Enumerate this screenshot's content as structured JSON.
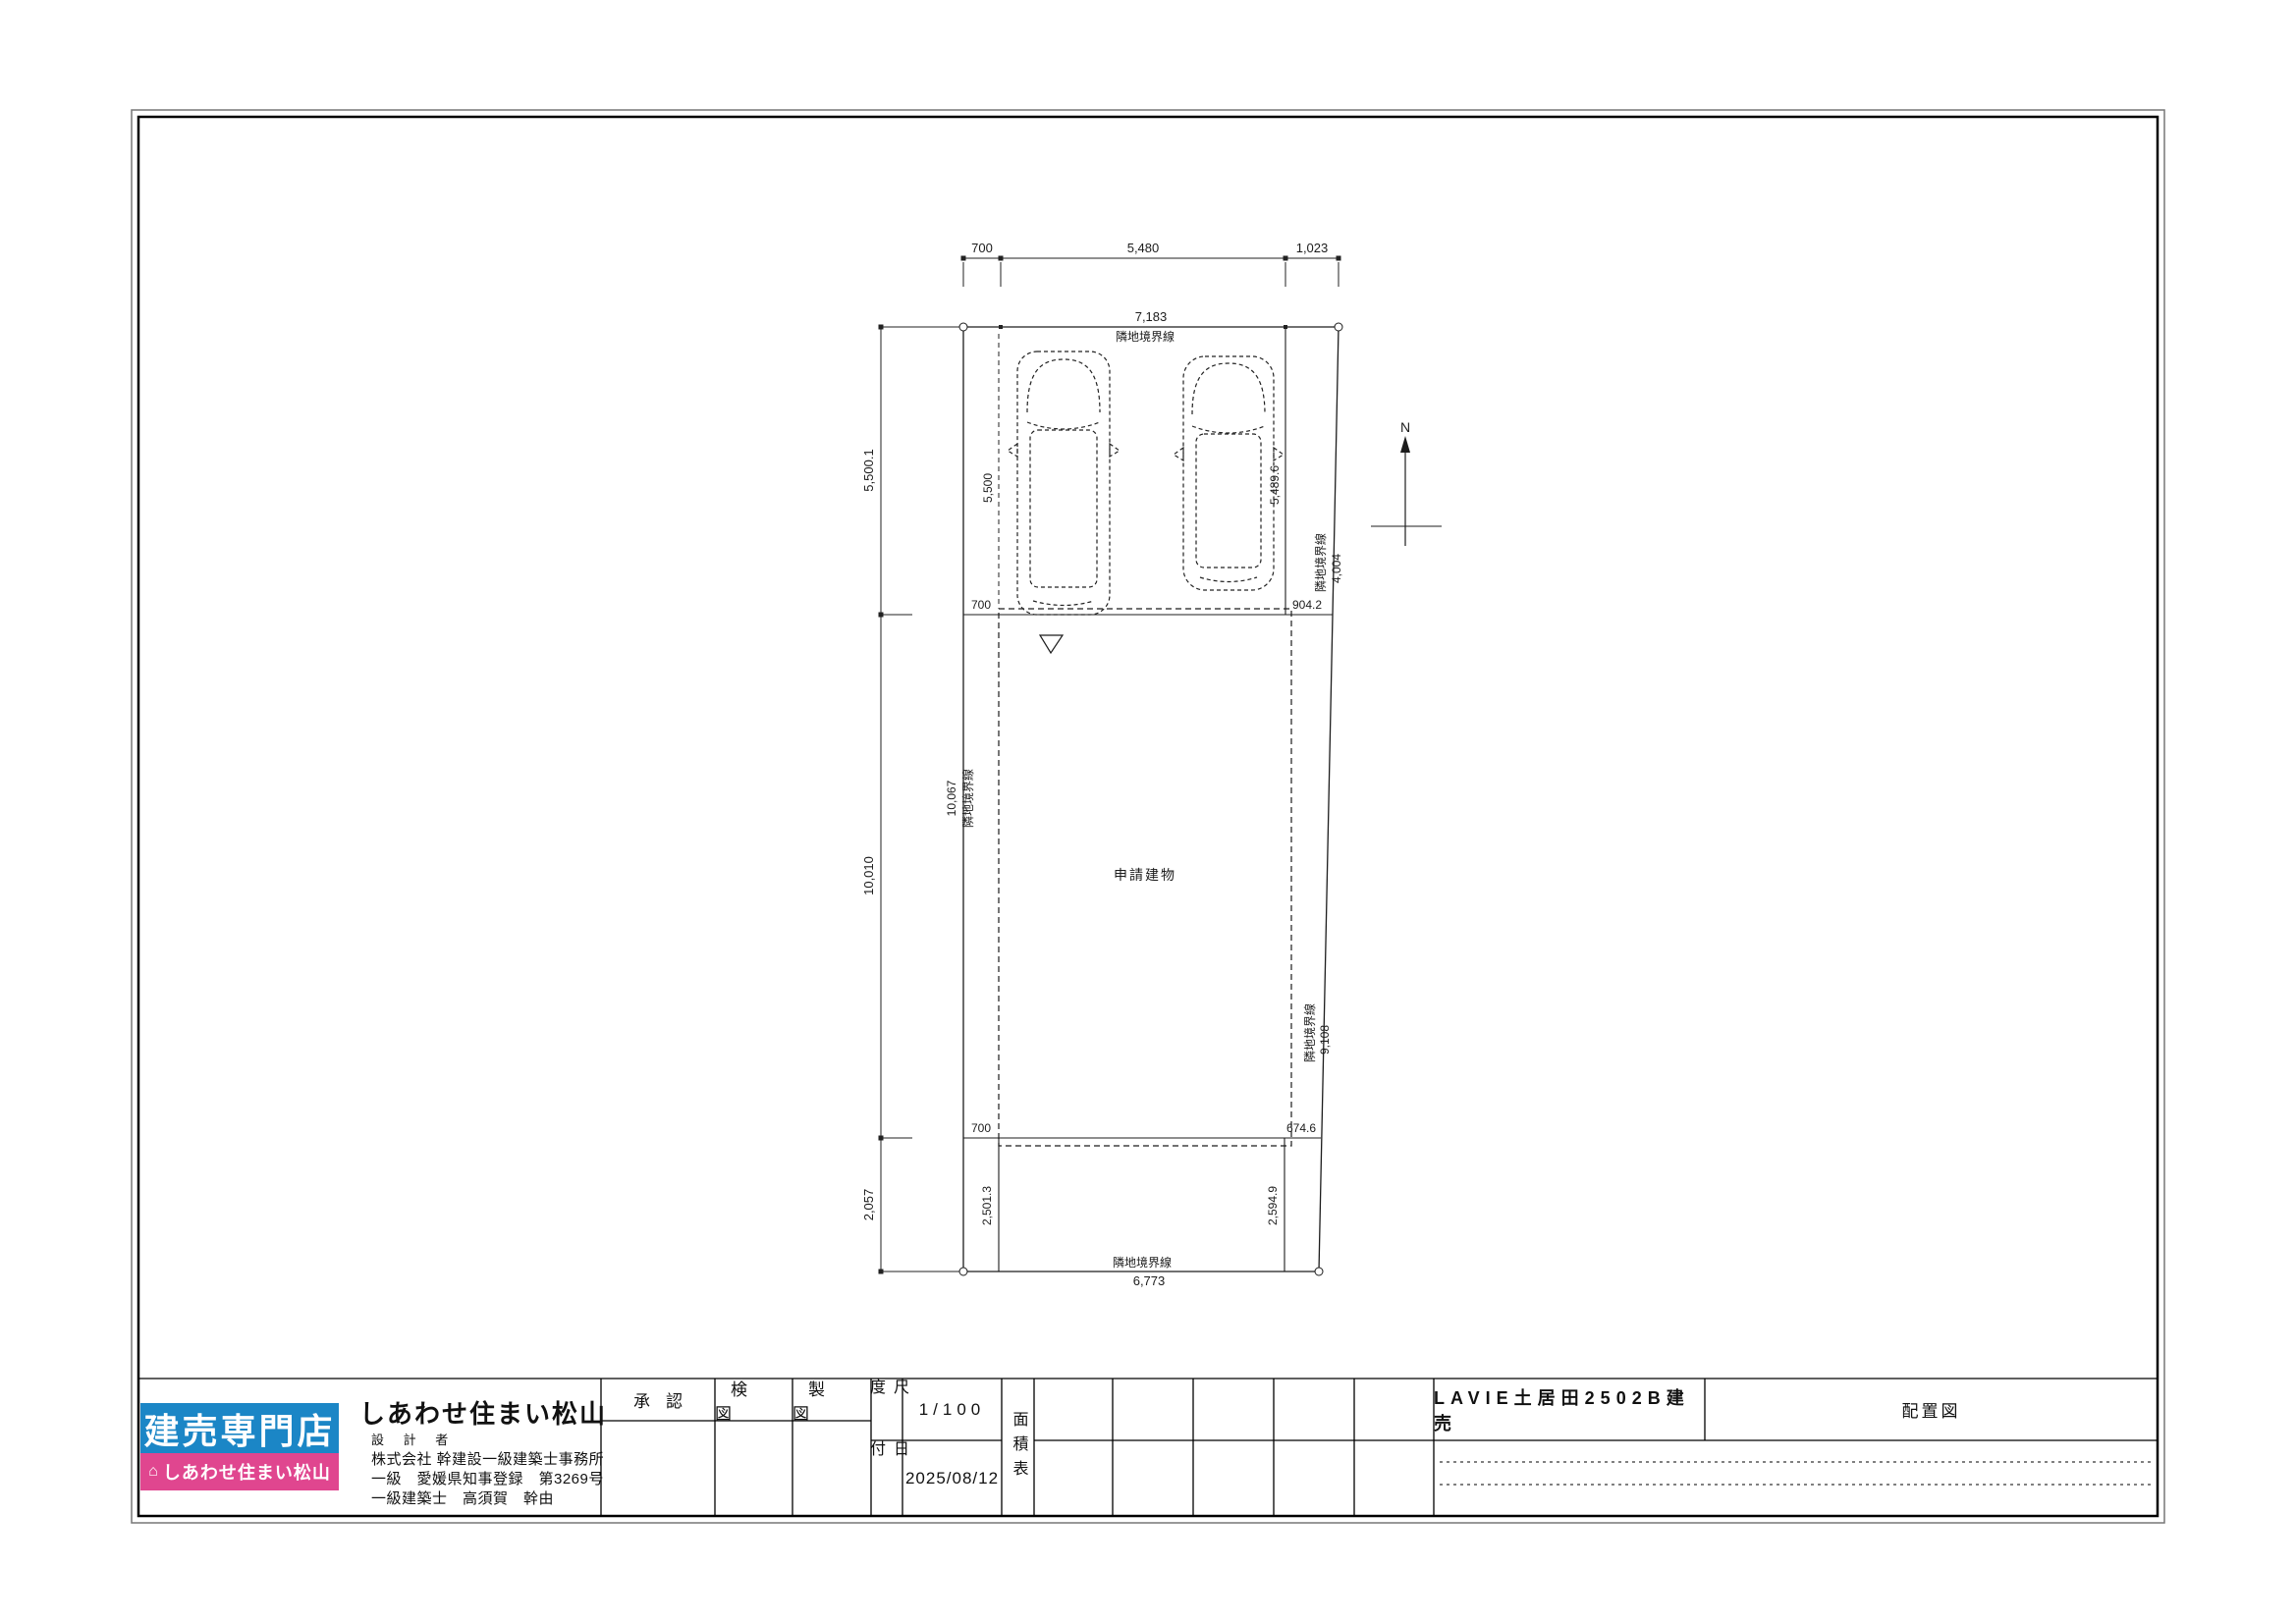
{
  "plan": {
    "north": "N",
    "building_label": "申請建物",
    "dims": {
      "top_left": "700",
      "top_mid": "5,480",
      "top_right": "1,023",
      "top_total": "7,183",
      "top_boundary": "隣地境界線",
      "left_upper": "5,500.1",
      "left_mid": "10,010",
      "left_lower": "2,057",
      "west_boundary_len": "10,067",
      "west_boundary_label": "隣地境界線",
      "park_left_depth": "5,500",
      "park_right_depth": "5,489.6",
      "upper_offset_left": "700",
      "upper_offset_right": "904.2",
      "lower_offset_left": "700",
      "lower_offset_right": "674.6",
      "east_upper_label": "隣地境界線",
      "east_upper_len": "4,004",
      "east_lower_label": "隣地境界線",
      "east_lower_len": "9,108",
      "rear_left": "2,501.3",
      "rear_right": "2,594.9",
      "south_boundary_label": "隣地境界線",
      "south_boundary_len": "6,773"
    }
  },
  "logo": {
    "top": "建売専門店",
    "bottom": "しあわせ住まい松山",
    "house_icon": "⌂",
    "blue": "#1b86c6",
    "pink": "#e0468f"
  },
  "company": {
    "name": "しあわせ住まい松山",
    "designer": "設 計 者",
    "office": "株式会社 幹建設一級建築士事務所",
    "license": "一級　愛媛県知事登録　第3269号",
    "architect": "一級建築士　高須賀　幹由"
  },
  "titleblock": {
    "approve": "承認",
    "check": "検図",
    "draft": "製図",
    "scale_label": "尺度",
    "scale_value": "1/100",
    "date_label": "日付",
    "date_value": "2025/08/12",
    "area_label": "面積表",
    "project": "LAVIE土居田2502B建売",
    "drawing_title": "配置図"
  }
}
